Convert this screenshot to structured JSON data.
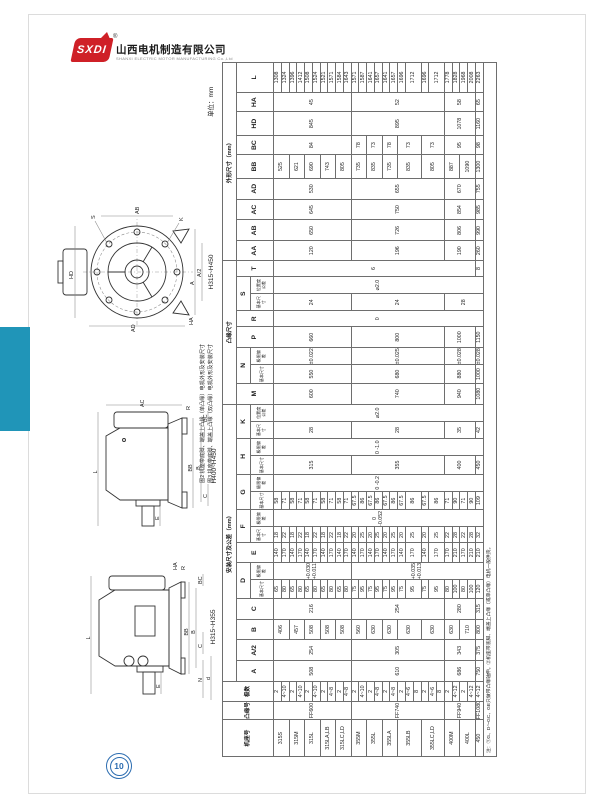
{
  "page": {
    "unit_label": "单位：mm",
    "page_number": "10"
  },
  "logo": {
    "abbr": "SXDI",
    "registered": "®",
    "company_cn": "山西电机制造有限公司",
    "company_en": "SHANXI ELECTRIC MOTOR MANUFACTURING Co.,Ltd"
  },
  "figures": {
    "note1": "图2 机座带底脚、端盖上凸缘（单凸缘）电机外形及安装尺寸",
    "note2": "图3 机座带底脚、端盖上凸缘（双凸缘）电机外形及安装尺寸",
    "fig1": {
      "labels": [
        "HD",
        "AD",
        "S",
        "K",
        "A",
        "A/2",
        "AB",
        "HA",
        "H315~H450"
      ]
    },
    "fig2": {
      "labels": [
        "L",
        "AC",
        "E",
        "BB",
        "B",
        "C",
        "BC",
        "R",
        "H400~H450"
      ]
    },
    "fig3": {
      "labels": [
        "L",
        "E",
        "N",
        "d",
        "BB",
        "B",
        "C",
        "BC",
        "R",
        "HA",
        "H315~H355"
      ]
    }
  },
  "table": {
    "col_widths": [
      30,
      15,
      16,
      17,
      17,
      17,
      17,
      15,
      14,
      16,
      13,
      14,
      15,
      14,
      15,
      14,
      14,
      14,
      17,
      15,
      14,
      17,
      13,
      14,
      14,
      13,
      16,
      17,
      17,
      17,
      19,
      16,
      19,
      16,
      24
    ],
    "header": [
      [
        {
          "t": "机座号",
          "r": 3
        },
        {
          "t": "凸缘号",
          "r": 3
        },
        {
          "t": "极数",
          "r": 3
        },
        {
          "t": "安装尺寸及公差（mm）",
          "c": 15
        },
        {
          "t": "凸缘尺寸",
          "c": 8
        },
        {
          "t": "外形尺寸（mm）",
          "c": 9
        }
      ],
      [
        {
          "t": "A",
          "r": 2
        },
        {
          "t": "A/2",
          "r": 2
        },
        {
          "t": "B",
          "r": 2
        },
        {
          "t": "C",
          "r": 2
        },
        {
          "t": "D",
          "c": 2
        },
        {
          "t": "E",
          "r": 2
        },
        {
          "t": "F",
          "c": 2
        },
        {
          "t": "G",
          "c": 2
        },
        {
          "t": "H",
          "c": 2
        },
        {
          "t": "K",
          "c": 2
        },
        {
          "t": "M",
          "r": 2
        },
        {
          "t": "N",
          "c": 2
        },
        {
          "t": "P",
          "r": 2
        },
        {
          "t": "R",
          "r": 2
        },
        {
          "t": "S",
          "c": 2
        },
        {
          "t": "T",
          "r": 2
        },
        {
          "t": "AA",
          "r": 2
        },
        {
          "t": "AB",
          "r": 2
        },
        {
          "t": "AC",
          "r": 2
        },
        {
          "t": "AD",
          "r": 2
        },
        {
          "t": "BB",
          "r": 2
        },
        {
          "t": "BC",
          "r": 2
        },
        {
          "t": "HD",
          "r": 2
        },
        {
          "t": "HA",
          "r": 2
        },
        {
          "t": "L",
          "r": 2
        }
      ],
      [
        {
          "t": "基本尺寸"
        },
        {
          "t": "极限偏差"
        },
        {
          "t": "基本尺寸"
        },
        {
          "t": "极限偏差"
        },
        {
          "t": "基本尺寸"
        },
        {
          "t": "极限偏差"
        },
        {
          "t": "基本尺寸"
        },
        {
          "t": "极限偏差"
        },
        {
          "t": "基本尺寸"
        },
        {
          "t": "位置度公差"
        },
        {
          "t": "基本尺寸"
        },
        {
          "t": "极限偏差"
        },
        {
          "t": "基本尺寸"
        },
        {
          "t": "位置度公差"
        }
      ]
    ],
    "body": [
      [
        {
          "t": "315S",
          "r": 2
        },
        {
          "t": "FF600",
          "r": 10
        },
        {
          "t": "2"
        },
        {
          "t": "508",
          "r": 10
        },
        {
          "t": "254",
          "r": 10
        },
        {
          "t": "406",
          "r": 2
        },
        {
          "t": "216",
          "r": 10
        },
        {
          "t": "65"
        },
        {
          "t": "+0.030 +0.011",
          "r": 10
        },
        {
          "t": "140"
        },
        {
          "t": "18"
        },
        {
          "t": "0 -0.052",
          "r": 27
        },
        {
          "t": "58"
        },
        {
          "t": "0 -0.2",
          "r": 27
        },
        {
          "t": "315",
          "r": 10
        },
        {
          "t": "0 -1.0",
          "r": 27
        },
        {
          "t": "28",
          "r": 10
        },
        {
          "t": "⌀2.0",
          "r": 27
        },
        {
          "t": "600",
          "r": 10
        },
        {
          "t": "550",
          "r": 10
        },
        {
          "t": "±0.022",
          "r": 10
        },
        {
          "t": "660",
          "r": 10
        },
        {
          "t": "0",
          "r": 27
        },
        {
          "t": "24",
          "r": 10
        },
        {
          "t": "⌀2.0",
          "r": 27
        },
        {
          "t": "6",
          "r": 26
        },
        {
          "t": "120",
          "r": 10
        },
        {
          "t": "650",
          "r": 10
        },
        {
          "t": "645",
          "r": 10
        },
        {
          "t": "530",
          "r": 10
        },
        {
          "t": "525",
          "r": 2
        },
        {
          "t": "84",
          "r": 10
        },
        {
          "t": "845",
          "r": 10
        },
        {
          "t": "45",
          "r": 10
        },
        {
          "t": "1308"
        }
      ],
      [
        {
          "t": "4~10"
        },
        {
          "t": "80"
        },
        {
          "t": "170"
        },
        {
          "t": "22"
        },
        {
          "t": "71"
        },
        {
          "t": "1324"
        }
      ],
      [
        {
          "t": "315M",
          "r": 2
        },
        {
          "t": "2"
        },
        {
          "t": "457",
          "r": 2
        },
        {
          "t": "65"
        },
        {
          "t": "140"
        },
        {
          "t": "18"
        },
        {
          "t": "58"
        },
        {
          "t": "621",
          "r": 2
        },
        {
          "t": "1396"
        }
      ],
      [
        {
          "t": "4~10"
        },
        {
          "t": "80"
        },
        {
          "t": "170"
        },
        {
          "t": "22"
        },
        {
          "t": "71"
        },
        {
          "t": "1412"
        }
      ],
      [
        {
          "t": "315L",
          "r": 2
        },
        {
          "t": "2"
        },
        {
          "t": "508",
          "r": 2
        },
        {
          "t": "65"
        },
        {
          "t": "140"
        },
        {
          "t": "18"
        },
        {
          "t": "58"
        },
        {
          "t": "690",
          "r": 2
        },
        {
          "t": "1508"
        }
      ],
      [
        {
          "t": "4~10"
        },
        {
          "t": "80"
        },
        {
          "t": "170"
        },
        {
          "t": "22"
        },
        {
          "t": "71"
        },
        {
          "t": "1524"
        }
      ],
      [
        {
          "t": "315LA,LB",
          "r": 2
        },
        {
          "t": "2"
        },
        {
          "t": "508",
          "r": 2
        },
        {
          "t": "65"
        },
        {
          "t": "140"
        },
        {
          "t": "18"
        },
        {
          "t": "58"
        },
        {
          "t": "743",
          "r": 2
        },
        {
          "t": "1521"
        }
      ],
      [
        {
          "t": "4~8"
        },
        {
          "t": "80"
        },
        {
          "t": "170"
        },
        {
          "t": "22"
        },
        {
          "t": "71"
        },
        {
          "t": "1571"
        }
      ],
      [
        {
          "t": "315LC,LD",
          "r": 2
        },
        {
          "t": "2"
        },
        {
          "t": "508",
          "r": 2
        },
        {
          "t": "65"
        },
        {
          "t": "140"
        },
        {
          "t": "18"
        },
        {
          "t": "58"
        },
        {
          "t": "805",
          "r": 2
        },
        {
          "t": "1584"
        }
      ],
      [
        {
          "t": "4~8"
        },
        {
          "t": "80"
        },
        {
          "t": "170"
        },
        {
          "t": "22"
        },
        {
          "t": "71"
        },
        {
          "t": "1643"
        }
      ],
      [
        {
          "t": "355M",
          "r": 2
        },
        {
          "t": "FF740",
          "r": 12
        },
        {
          "t": "2"
        },
        {
          "t": "610",
          "r": 12
        },
        {
          "t": "305",
          "r": 12
        },
        {
          "t": "560",
          "r": 2
        },
        {
          "t": "254",
          "r": 12
        },
        {
          "t": "75"
        },
        {
          "t": "+0.035 +0.013",
          "r": 17
        },
        {
          "t": "140"
        },
        {
          "t": "20"
        },
        {
          "t": "67.5"
        },
        {
          "t": "355",
          "r": 12
        },
        {
          "t": "28",
          "r": 12
        },
        {
          "t": "740",
          "r": 12
        },
        {
          "t": "680",
          "r": 12
        },
        {
          "t": "±0.025",
          "r": 12
        },
        {
          "t": "800",
          "r": 12
        },
        {
          "t": "24",
          "r": 12
        },
        {
          "t": "196",
          "r": 12
        },
        {
          "t": "726",
          "r": 12
        },
        {
          "t": "750",
          "r": 12
        },
        {
          "t": "655",
          "r": 12
        },
        {
          "t": "735",
          "r": 2
        },
        {
          "t": "78",
          "r": 2
        },
        {
          "t": "895",
          "r": 12
        },
        {
          "t": "52",
          "r": 12
        },
        {
          "t": "1571"
        }
      ],
      [
        {
          "t": "4~10"
        },
        {
          "t": "95"
        },
        {
          "t": "170"
        },
        {
          "t": "25"
        },
        {
          "t": "86"
        },
        {
          "t": "1587"
        }
      ],
      [
        {
          "t": "355L",
          "r": 2
        },
        {
          "t": "2"
        },
        {
          "t": "630",
          "r": 2
        },
        {
          "t": "75"
        },
        {
          "t": "140"
        },
        {
          "t": "20"
        },
        {
          "t": "67.5"
        },
        {
          "t": "835",
          "r": 2
        },
        {
          "t": "73",
          "r": 2
        },
        {
          "t": "1641"
        }
      ],
      [
        {
          "t": "4~8"
        },
        {
          "t": "95"
        },
        {
          "t": "170"
        },
        {
          "t": "25"
        },
        {
          "t": "86"
        },
        {
          "t": "1657"
        }
      ],
      [
        {
          "t": "355LA",
          "r": 2
        },
        {
          "t": "2"
        },
        {
          "t": "630",
          "r": 2
        },
        {
          "t": "75"
        },
        {
          "t": "140"
        },
        {
          "t": "20"
        },
        {
          "t": "67.5"
        },
        {
          "t": "735",
          "r": 2
        },
        {
          "t": "78",
          "r": 2
        },
        {
          "t": "1641"
        }
      ],
      [
        {
          "t": "4~8"
        },
        {
          "t": "95"
        },
        {
          "t": "170"
        },
        {
          "t": "25"
        },
        {
          "t": "86"
        },
        {
          "t": "1657"
        }
      ],
      [
        {
          "t": "355LB",
          "r": 3
        },
        {
          "t": "2"
        },
        {
          "t": "630",
          "r": 3
        },
        {
          "t": "75"
        },
        {
          "t": "140"
        },
        {
          "t": "20"
        },
        {
          "t": "67.5"
        },
        {
          "t": "835",
          "r": 3
        },
        {
          "t": "73",
          "r": 3
        },
        {
          "t": "1696"
        }
      ],
      [
        {
          "t": "4~6"
        },
        {
          "t": "95",
          "r": 2
        },
        {
          "t": "170",
          "r": 2
        },
        {
          "t": "25",
          "r": 2
        },
        {
          "t": "86",
          "r": 2
        },
        {
          "t": "1712",
          "r": 2
        }
      ],
      [
        {
          "t": "8"
        }
      ],
      [
        {
          "t": "355LC,LD",
          "r": 3
        },
        {
          "t": "2"
        },
        {
          "t": "630",
          "r": 3
        },
        {
          "t": "75"
        },
        {
          "t": "140"
        },
        {
          "t": "20"
        },
        {
          "t": "67.5"
        },
        {
          "t": "805",
          "r": 3
        },
        {
          "t": "73",
          "r": 3
        },
        {
          "t": "1696"
        }
      ],
      [
        {
          "t": "4~6"
        },
        {
          "t": "95",
          "r": 2
        },
        {
          "t": "170",
          "r": 2
        },
        {
          "t": "25",
          "r": 2
        },
        {
          "t": "86",
          "r": 2
        },
        {
          "t": "1712",
          "r": 2
        }
      ],
      [
        {
          "t": "8"
        }
      ],
      [
        {
          "t": "400M",
          "r": 2
        },
        {
          "t": "FF940",
          "r": 4
        },
        {
          "t": "2"
        },
        {
          "t": "686",
          "r": 4
        },
        {
          "t": "343",
          "r": 4
        },
        {
          "t": "630",
          "r": 2
        },
        {
          "t": "280",
          "r": 4
        },
        {
          "t": "80"
        },
        {
          "t": "170"
        },
        {
          "t": "22"
        },
        {
          "t": "71"
        },
        {
          "t": "400",
          "r": 4
        },
        {
          "t": "35",
          "r": 4
        },
        {
          "t": "940",
          "r": 4
        },
        {
          "t": "880",
          "r": 4
        },
        {
          "t": "±0.028",
          "r": 4
        },
        {
          "t": "1000",
          "r": 4
        },
        {
          "t": "28",
          "r": 5
        },
        {
          "t": "190",
          "r": 4
        },
        {
          "t": "806",
          "r": 4
        },
        {
          "t": "854",
          "r": 4
        },
        {
          "t": "670",
          "r": 4
        },
        {
          "t": "887",
          "r": 2
        },
        {
          "t": "95",
          "r": 4
        },
        {
          "t": "1078",
          "r": 4
        },
        {
          "t": "58",
          "r": 4
        },
        {
          "t": "1778"
        }
      ],
      [
        {
          "t": "4~12"
        },
        {
          "t": "100"
        },
        {
          "t": "210"
        },
        {
          "t": "28"
        },
        {
          "t": "90"
        },
        {
          "t": "1828"
        }
      ],
      [
        {
          "t": "400L",
          "r": 2
        },
        {
          "t": "2"
        },
        {
          "t": "710",
          "r": 2
        },
        {
          "t": "80"
        },
        {
          "t": "170"
        },
        {
          "t": "22"
        },
        {
          "t": "71"
        },
        {
          "t": "1090",
          "r": 2
        },
        {
          "t": "1968"
        }
      ],
      [
        {
          "t": "4~12"
        },
        {
          "t": "100"
        },
        {
          "t": "210"
        },
        {
          "t": "28"
        },
        {
          "t": "90"
        },
        {
          "t": "2008"
        }
      ],
      [
        {
          "t": "450"
        },
        {
          "t": "FF1080"
        },
        {
          "t": "4~12"
        },
        {
          "t": "750"
        },
        {
          "t": "375"
        },
        {
          "t": "800"
        },
        {
          "t": "315"
        },
        {
          "t": "120"
        },
        {
          "t": "210"
        },
        {
          "t": "32"
        },
        {
          "t": "109"
        },
        {
          "t": "450"
        },
        {
          "t": "42"
        },
        {
          "t": "1080"
        },
        {
          "t": "1000"
        },
        {
          "t": "±0.028"
        },
        {
          "t": "1150"
        },
        {
          "t": "8"
        },
        {
          "t": "260"
        },
        {
          "t": "990"
        },
        {
          "t": "985"
        },
        {
          "t": "755"
        },
        {
          "t": "1300"
        },
        {
          "t": "98"
        },
        {
          "t": "1160"
        },
        {
          "t": "65"
        },
        {
          "t": "2263"
        }
      ]
    ],
    "note": "注：①G、D～GC、GE只做带凸缘轴伸。②机座带底脚、端盖上凸缘（或单凸缘）电机一般供货。"
  }
}
